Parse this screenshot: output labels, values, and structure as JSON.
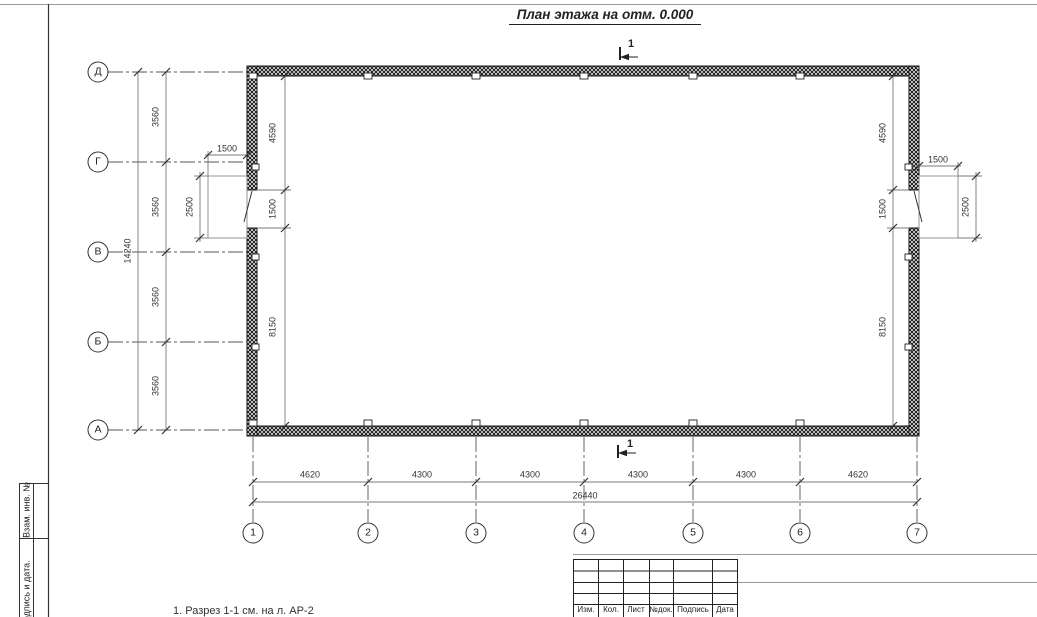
{
  "sheet": {
    "title": "План этажа на отм. 0.000",
    "note": "1. Разрез 1-1 см. на л. АР-2",
    "section_label": "1"
  },
  "axes": {
    "rows": [
      {
        "label": "Д"
      },
      {
        "label": "Г"
      },
      {
        "label": "В"
      },
      {
        "label": "Б"
      },
      {
        "label": "А"
      }
    ],
    "cols": [
      {
        "label": "1"
      },
      {
        "label": "2"
      },
      {
        "label": "3"
      },
      {
        "label": "4"
      },
      {
        "label": "5"
      },
      {
        "label": "6"
      },
      {
        "label": "7"
      }
    ]
  },
  "dims": {
    "row_spacing": [
      "3560",
      "3560",
      "3560",
      "3560"
    ],
    "row_total": "14240",
    "col_spacing": [
      "4620",
      "4300",
      "4300",
      "4300",
      "4300",
      "4620"
    ],
    "col_total": "26440",
    "interior_left": [
      "4590",
      "1500",
      "8150"
    ],
    "interior_right": [
      "4590",
      "1500",
      "8150"
    ],
    "door_left": {
      "width": "1500",
      "depth": "2500"
    },
    "door_right": {
      "width": "1500",
      "depth": "2500"
    }
  },
  "margin": {
    "labels": [
      "Взам. инв. №",
      "Подпись и дата."
    ]
  },
  "stamp": {
    "headers": [
      "Изм.",
      "Кол.",
      "Лист",
      "№док.",
      "Подпись",
      "Дата"
    ]
  }
}
